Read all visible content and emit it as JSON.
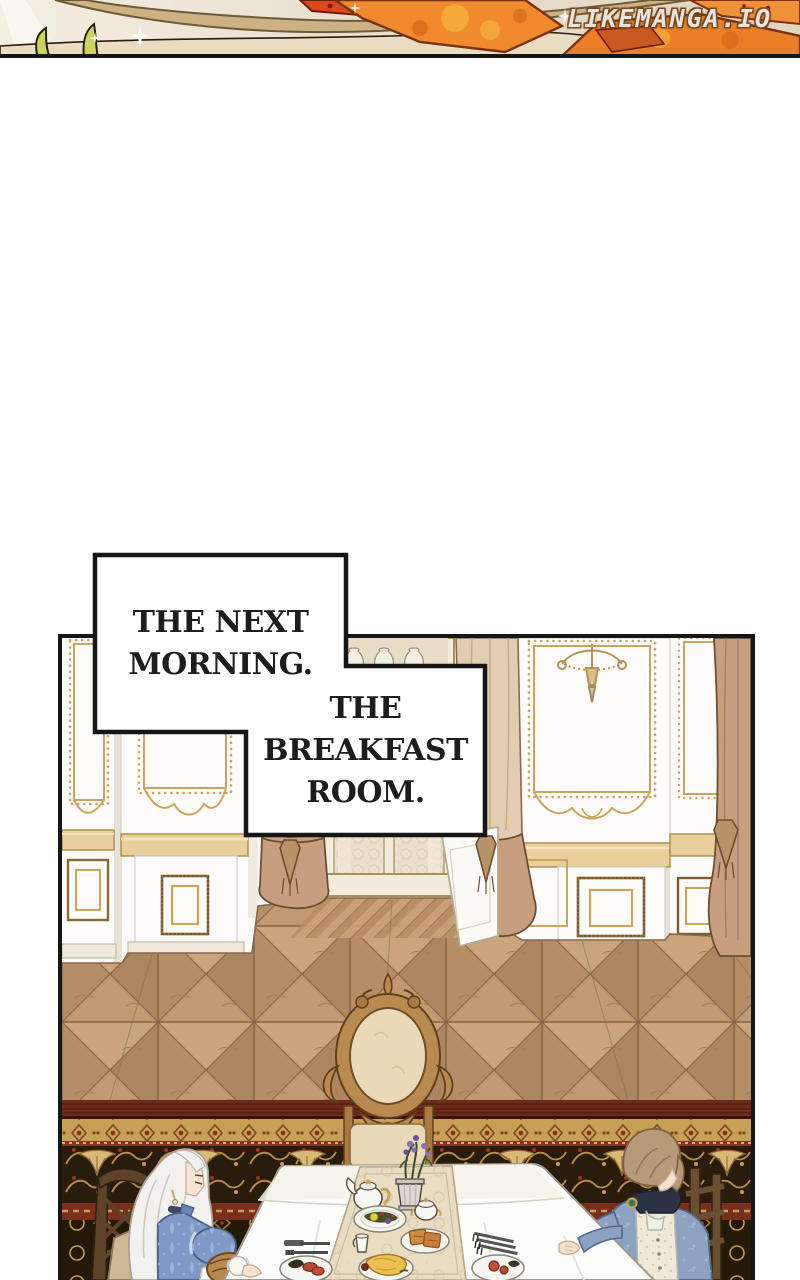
{
  "watermark": {
    "text": "LIKEMANGA.IO"
  },
  "captions": {
    "next_morning": {
      "text": "THE NEXT\nMORNING."
    },
    "breakfast_room": {
      "text": "THE\nBREAKFAST\nROOM."
    }
  },
  "palette": {
    "ink": "#161616",
    "paper": "#ffffff",
    "flame_orange": "#ef8a2e",
    "ribbon_tan": "#cdb083",
    "sprout_green": "#ccd35a",
    "wall_white": "#fbfaf8",
    "gold_trim": "#c9a55f",
    "curtain_tan": "#c79f7e",
    "floor_wood": "#c19a72",
    "rug_red": "#6e2a1a",
    "rug_gold": "#c79f56",
    "rug_field_dark": "#241806",
    "tablecloth": "#fcfcfa",
    "runner_beige": "#e8ddc3",
    "dress_blue": "#8099c6",
    "jacket_blue": "#8ba2c2",
    "hair_white": "#f3f1ed",
    "hair_brown": "#b79b79",
    "flower_purple": "#8d6fb5"
  }
}
